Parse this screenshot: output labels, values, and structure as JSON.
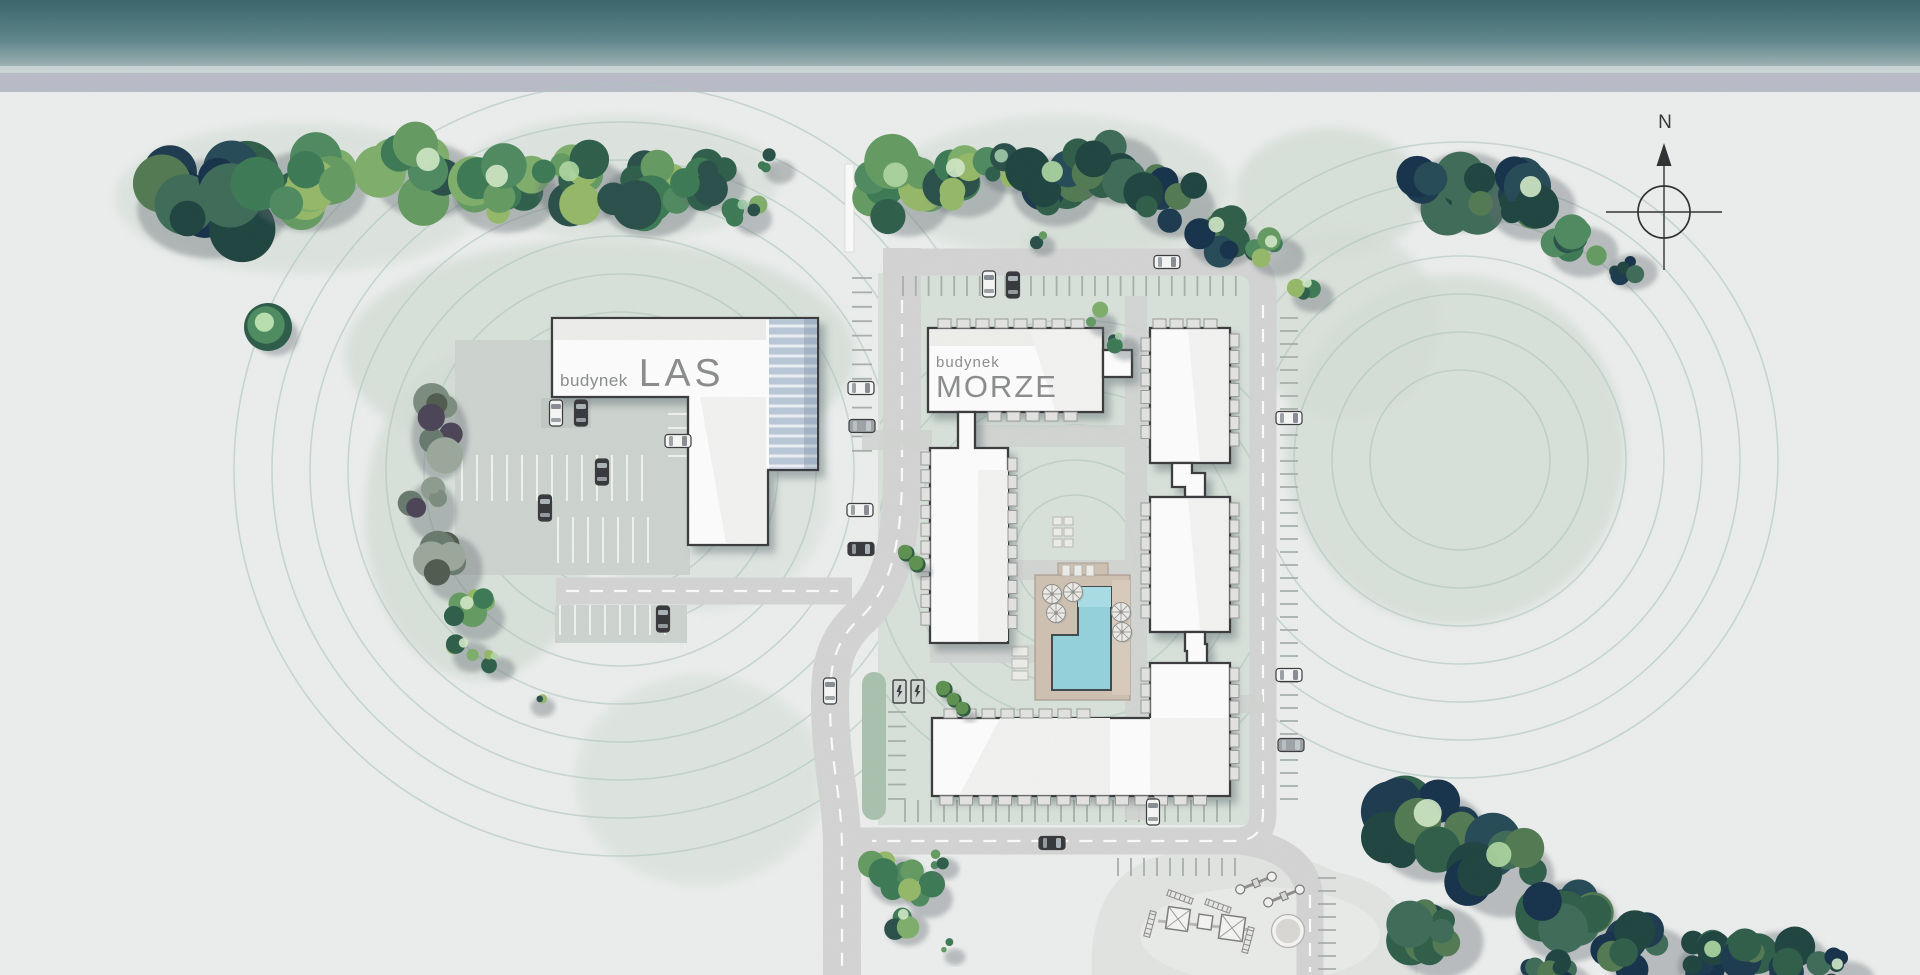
{
  "site_plan": {
    "buildings": [
      {
        "id": "las",
        "prefix": "budynek",
        "name": "LAS"
      },
      {
        "id": "morze",
        "prefix": "budynek",
        "name": "MORZE"
      }
    ],
    "compass": {
      "north_label": "N"
    },
    "icons": {
      "compass": "compass-rose",
      "ev_charger": "lightning-bolt",
      "umbrella": "parasol-top-view"
    },
    "colors": {
      "sea_dark": "#39646a",
      "sea_light": "#93aaac",
      "beach_strip": "#b9bcc8",
      "ground": "#eceeed",
      "landscape_green": "#d4ded6",
      "contour_line": "#afc7be",
      "road": "#d3d4d3",
      "road_marking": "#ffffff",
      "parking_lot": "#cdd4cf",
      "building_fill": "#fdfdfd",
      "building_outline": "#3b3b3d",
      "glass_roof": "#b9c7d7",
      "pool_water": "#93d2dc",
      "pool_deck": "#cfc1b2",
      "tree_green": "#3c7a54",
      "tree_dark": "#1d3a4e",
      "label_text": "#8a8d8c"
    }
  }
}
